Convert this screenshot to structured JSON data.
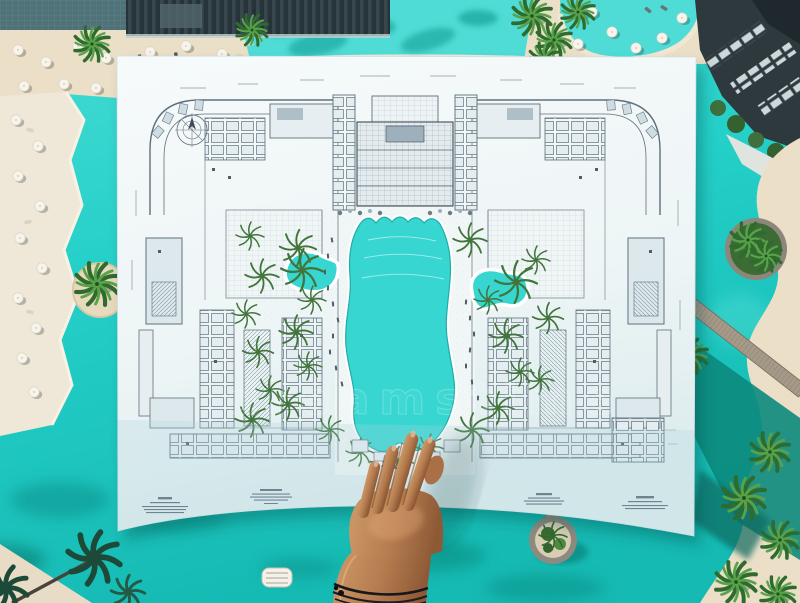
{
  "watermark": {
    "text": "dreamstime"
  },
  "scene": {
    "subject": "aerial-resort-pool-with-floorplan-sheet",
    "elements": {
      "paper": "architectural-floorplan-sheet",
      "hand": "hand-touching-plan",
      "water": "turquoise-lagoon-pool",
      "left_wing": "hotel-wing-plan-left",
      "right_wing": "hotel-wing-plan-right",
      "main_building": "main-building-plan",
      "pools_on_plan": [
        "main-lagoon-pool",
        "left-kidney-pool",
        "right-freeform-pool"
      ]
    }
  },
  "colors": {
    "water": "#21cfc7",
    "water_light": "#55ddd5",
    "water_deep": "#14b5ae",
    "water_dark_green": "#0c8a7d",
    "sand": "#ecdfc8",
    "deck": "#efe8d8",
    "paper": "#f3f8f8",
    "plan_line": "#5e707c",
    "plan_fill": "#dde8ec",
    "pool_plan": "#38d6d0",
    "palm_green": "#4f9a44",
    "plan_palm_green": "#41753c",
    "skin": "#b5794f",
    "building_dark": "#26343a",
    "bracelet": "#17181c"
  }
}
